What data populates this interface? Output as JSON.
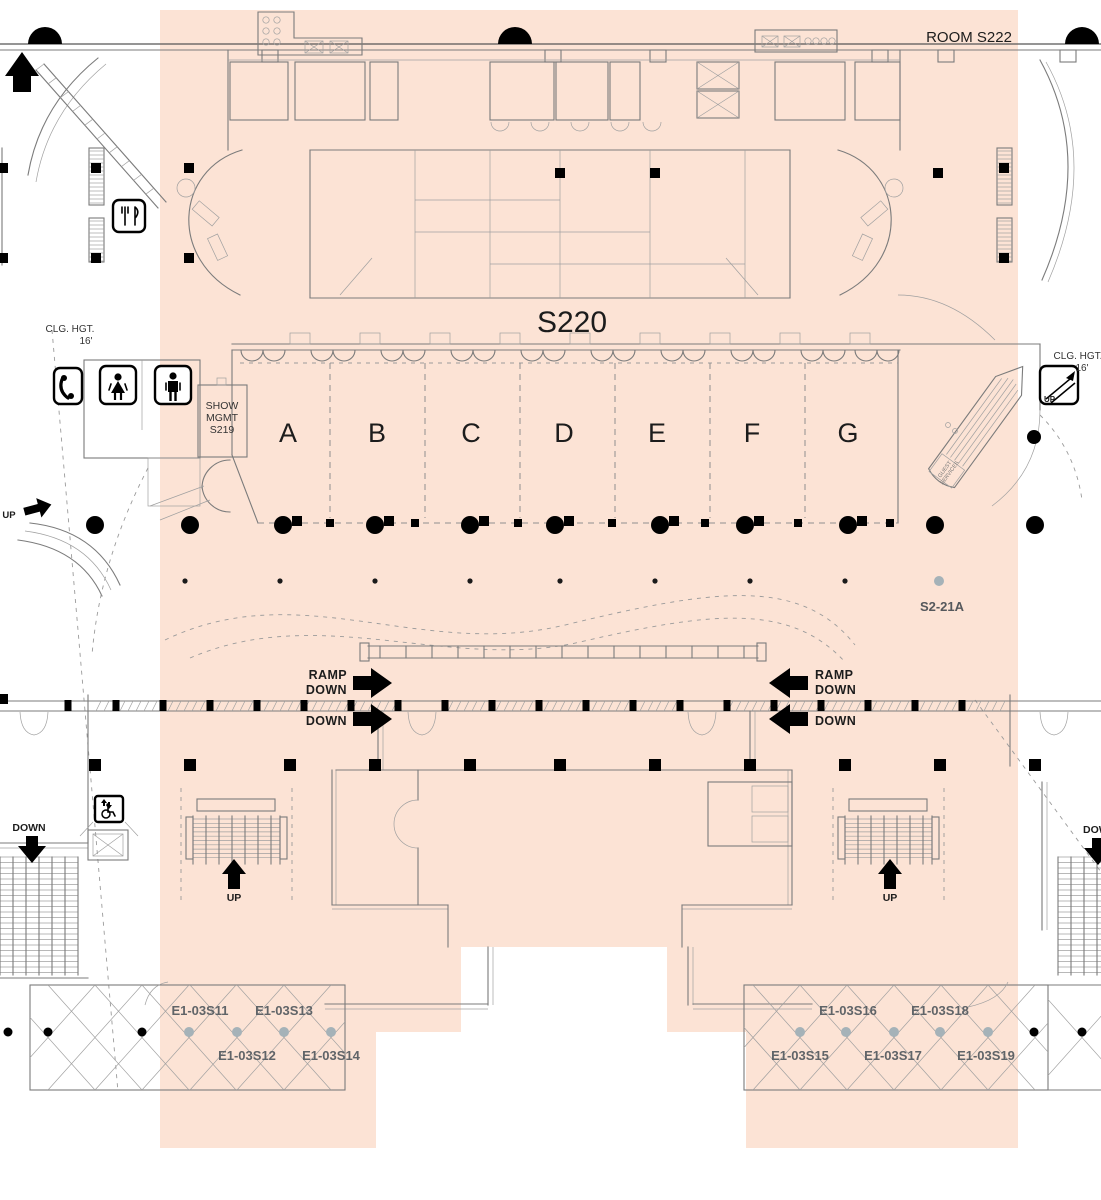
{
  "colors": {
    "highlight": "#fce3d5",
    "wall": "#7b7b7b",
    "ink": "#000000",
    "utility_label": "#606468",
    "utility_dot": "#a5b2b8"
  },
  "labels": {
    "room_s222": "ROOM S222",
    "hall": "S220",
    "show_mgmt": [
      "SHOW",
      "MGMT",
      "S219"
    ],
    "s2_21a": "S2-21A",
    "guest_services": [
      "GUEST",
      "SERVICES"
    ],
    "clg_hgt": "CLG. HGT.",
    "clg_val": "16'"
  },
  "sections": [
    "A",
    "B",
    "C",
    "D",
    "E",
    "F",
    "G"
  ],
  "nav": {
    "ramp": "RAMP",
    "down": "DOWN",
    "up": "UP"
  },
  "utilities": {
    "left": [
      "E1-03S11",
      "E1-03S12",
      "E1-03S13",
      "E1-03S14"
    ],
    "right": [
      "E1-03S15",
      "E1-03S16",
      "E1-03S17",
      "E1-03S18",
      "E1-03S19"
    ]
  },
  "icons": [
    "phone-icon",
    "womens-restroom-icon",
    "mens-restroom-icon",
    "food-icon",
    "escalator-up-icon",
    "accessible-elevator-icon"
  ]
}
